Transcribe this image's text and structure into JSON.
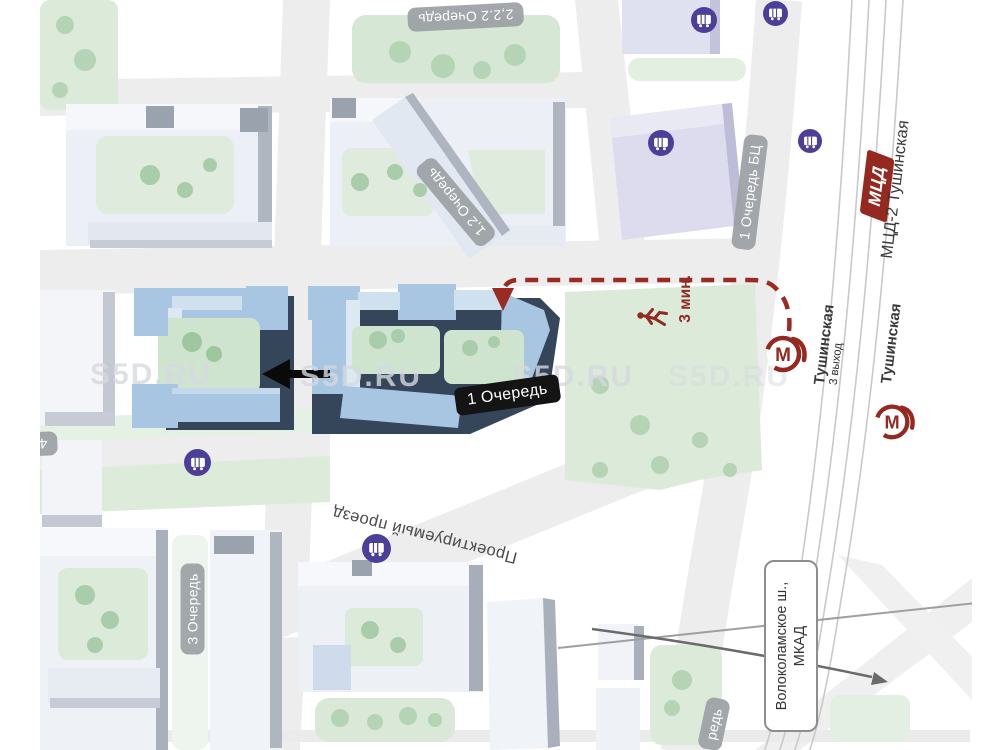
{
  "labels": {
    "phase_2_top": "2,2.2 Очередь",
    "phase_1_2": "1,2 Очередь",
    "phase_1_bc": "1 Очередь БЦ",
    "phase_1": "1 Очередь",
    "phase_3": "3 Очередь",
    "phase_4_partial": "4 О",
    "phase_partial_bottom": "редь",
    "mcd_badge": "МЦД",
    "mcd_station": "МЦД-2 Тушинская",
    "metro_station_west": "Тушинская",
    "metro_exit": "3 выход",
    "metro_station_east": "Тушинская",
    "walk_time": "3 мин.",
    "projected_drive": "Проектируемый проезд",
    "highway_line1": "Волоколамское ш.,",
    "highway_line2": "МКАД",
    "metro_letter": "М"
  },
  "watermark": "S5D.RU",
  "icons": {
    "metro": "metro-station-m-logo",
    "bus": "bus-stop",
    "pedestrian": "walking-person"
  },
  "colors": {
    "metro_red": "#96291f",
    "route_red": "#9b2b22",
    "bus_purple": "#4c3f99",
    "active_building_blue": "#a8c6e1",
    "active_building_shadow": "#36465a",
    "faded_building": "#eceff5",
    "business_center_lavender": "#dcdcee",
    "green_area": "#d9e8d7",
    "road_gray": "#ededed",
    "badge_gray": "#9b9fa4",
    "badge_black": "#141414"
  }
}
